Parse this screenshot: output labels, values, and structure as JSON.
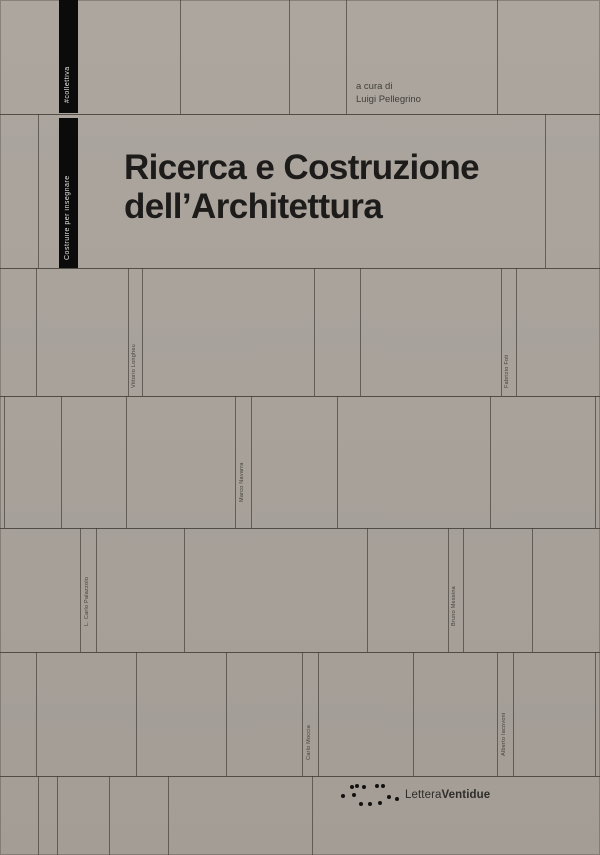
{
  "cover": {
    "title_line1": "Ricerca e Costruzione",
    "title_line2": "dell’Architettura",
    "editor": {
      "prefix": "a cura di",
      "name": "Luigi Pellegrino"
    },
    "spine": {
      "series_tag": "#collettiva",
      "series_title": "Costruire per insegnare"
    },
    "contributors": [
      "Vittorio Longheu",
      "Fabrizio Foti",
      "Marco Navarra",
      "L. Carlo Palazzolo",
      "Bruno Messina",
      "Carlo Moccia",
      "Alberto Iacovoni"
    ],
    "publisher": {
      "name_light": "Lettera",
      "name_bold": "Ventidue"
    },
    "colors": {
      "background": "#a8a29b",
      "joint_line": "#3e3a33",
      "spine_band": "#0b0b0b",
      "title_text": "#1d1c1a"
    }
  }
}
